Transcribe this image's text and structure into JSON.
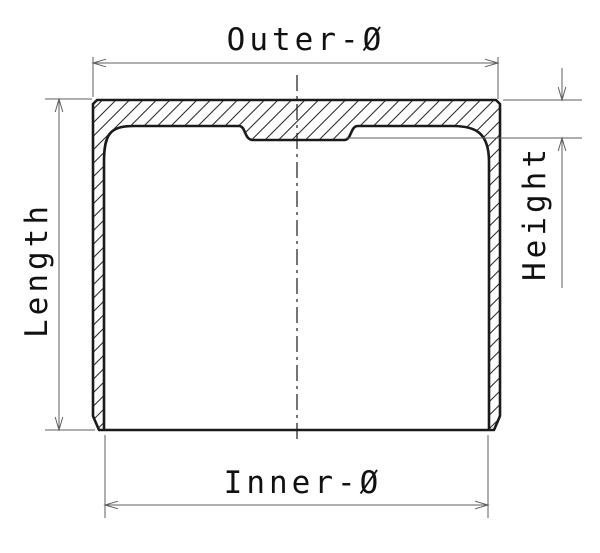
{
  "drawing": {
    "title": "Sectioned cup part with dimension callouts",
    "labels": {
      "outer_diameter": "Outer-Ø",
      "inner_diameter": "Inner-Ø",
      "length": "Length",
      "height": "Height"
    },
    "colors": {
      "background": "#ffffff",
      "outline": "#1a1a1a",
      "hatch": "#2f2f2f",
      "dimension_lines": "#5f5f5f",
      "text": "#111111"
    }
  }
}
